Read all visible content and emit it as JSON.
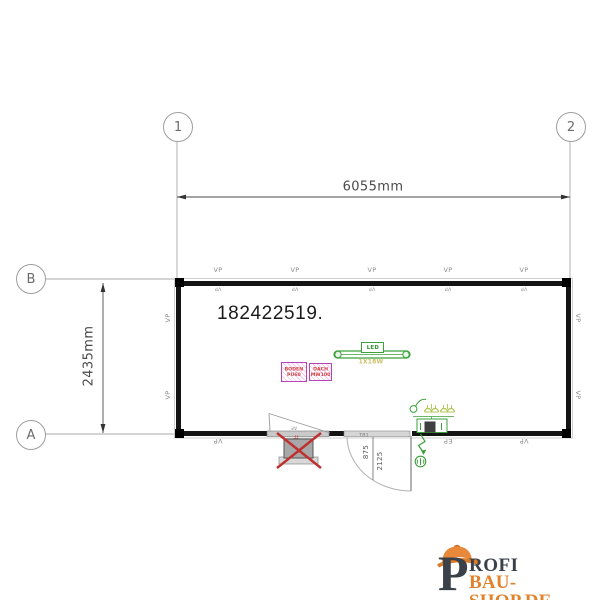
{
  "drawing": {
    "order_number": "182422519.",
    "grid": {
      "columns": [
        "1",
        "2"
      ],
      "rows": [
        "B",
        "A"
      ]
    },
    "dimensions": {
      "overall_width": "6055mm",
      "overall_height": "2435mm",
      "door_width": "875",
      "door_height": "2125"
    },
    "labels": {
      "wall_panel": "VP",
      "electrical_panel": "EP",
      "door_tag": "TB1",
      "window_tag": "AF",
      "removed_window_tag": "FF"
    },
    "fixtures": {
      "ceiling_light": {
        "type_label": "LED",
        "code": "1X18W"
      },
      "floor_spec": {
        "line1": "BODEN",
        "line2": "PU60"
      },
      "roof_spec": {
        "line1": "DACH",
        "line2": "MW100"
      }
    }
  },
  "logo": {
    "initial": "P",
    "name": "ROFI",
    "tagline": "BAU-SHOP.DE"
  },
  "colors": {
    "wall": "#141414",
    "electrical_green": "#3aa03a",
    "socket_yellow": "#b3c455",
    "insulation_magenta": "#b843b8",
    "spec_text_red": "#d04040",
    "led_code_yellow": "#cfbe66",
    "cross_red": "#c03030",
    "logo_orange": "#e0832c",
    "logo_dark": "#3a4148"
  }
}
